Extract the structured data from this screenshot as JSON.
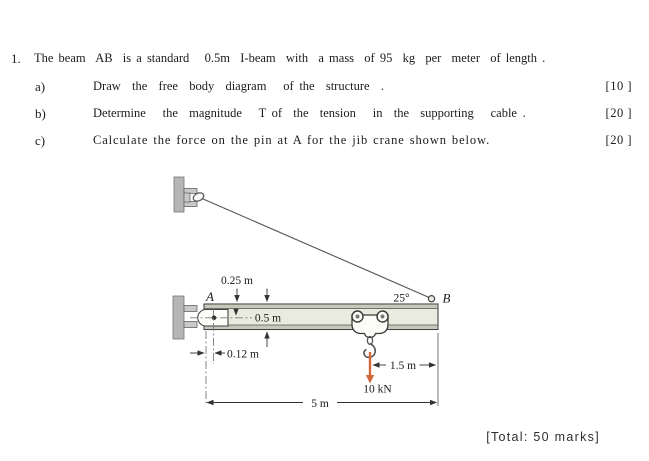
{
  "problem": {
    "number": "1.",
    "statement": "The beam  AB  is a standard   0.5m  I-beam  with  a mass  of 95  kg  per  meter  of length .",
    "parts": [
      {
        "label": "a)",
        "text": "Draw  the  free  body  diagram   of the  structure  .",
        "marks": "[10 ]"
      },
      {
        "label": "b)",
        "text": "Determine   the  magnitude   T of  the  tension   in  the  supporting   cable .",
        "marks": "[20 ]"
      },
      {
        "label": "c)",
        "text": "Calculate the force on the pin at A for the jib crane shown below.",
        "marks": "[20 ]"
      }
    ],
    "total": "[Total: 50 marks]"
  },
  "diagram": {
    "labels": {
      "dim_025": "0.25 m",
      "point_a": "A",
      "angle_b": "25°",
      "point_b": "B",
      "dim_05": "0.5 m",
      "dim_012": "0.12 m",
      "dim_15": "1.5 m",
      "force": "10 kN",
      "dim_5": "5 m"
    },
    "colors": {
      "beam_fill": "#e9ebdf",
      "flange_fill": "#c6c8ba",
      "wall_fill": "#b5b5b5",
      "bracket_fill": "#c8c8c8",
      "force_arrow": "#d2693c"
    }
  }
}
